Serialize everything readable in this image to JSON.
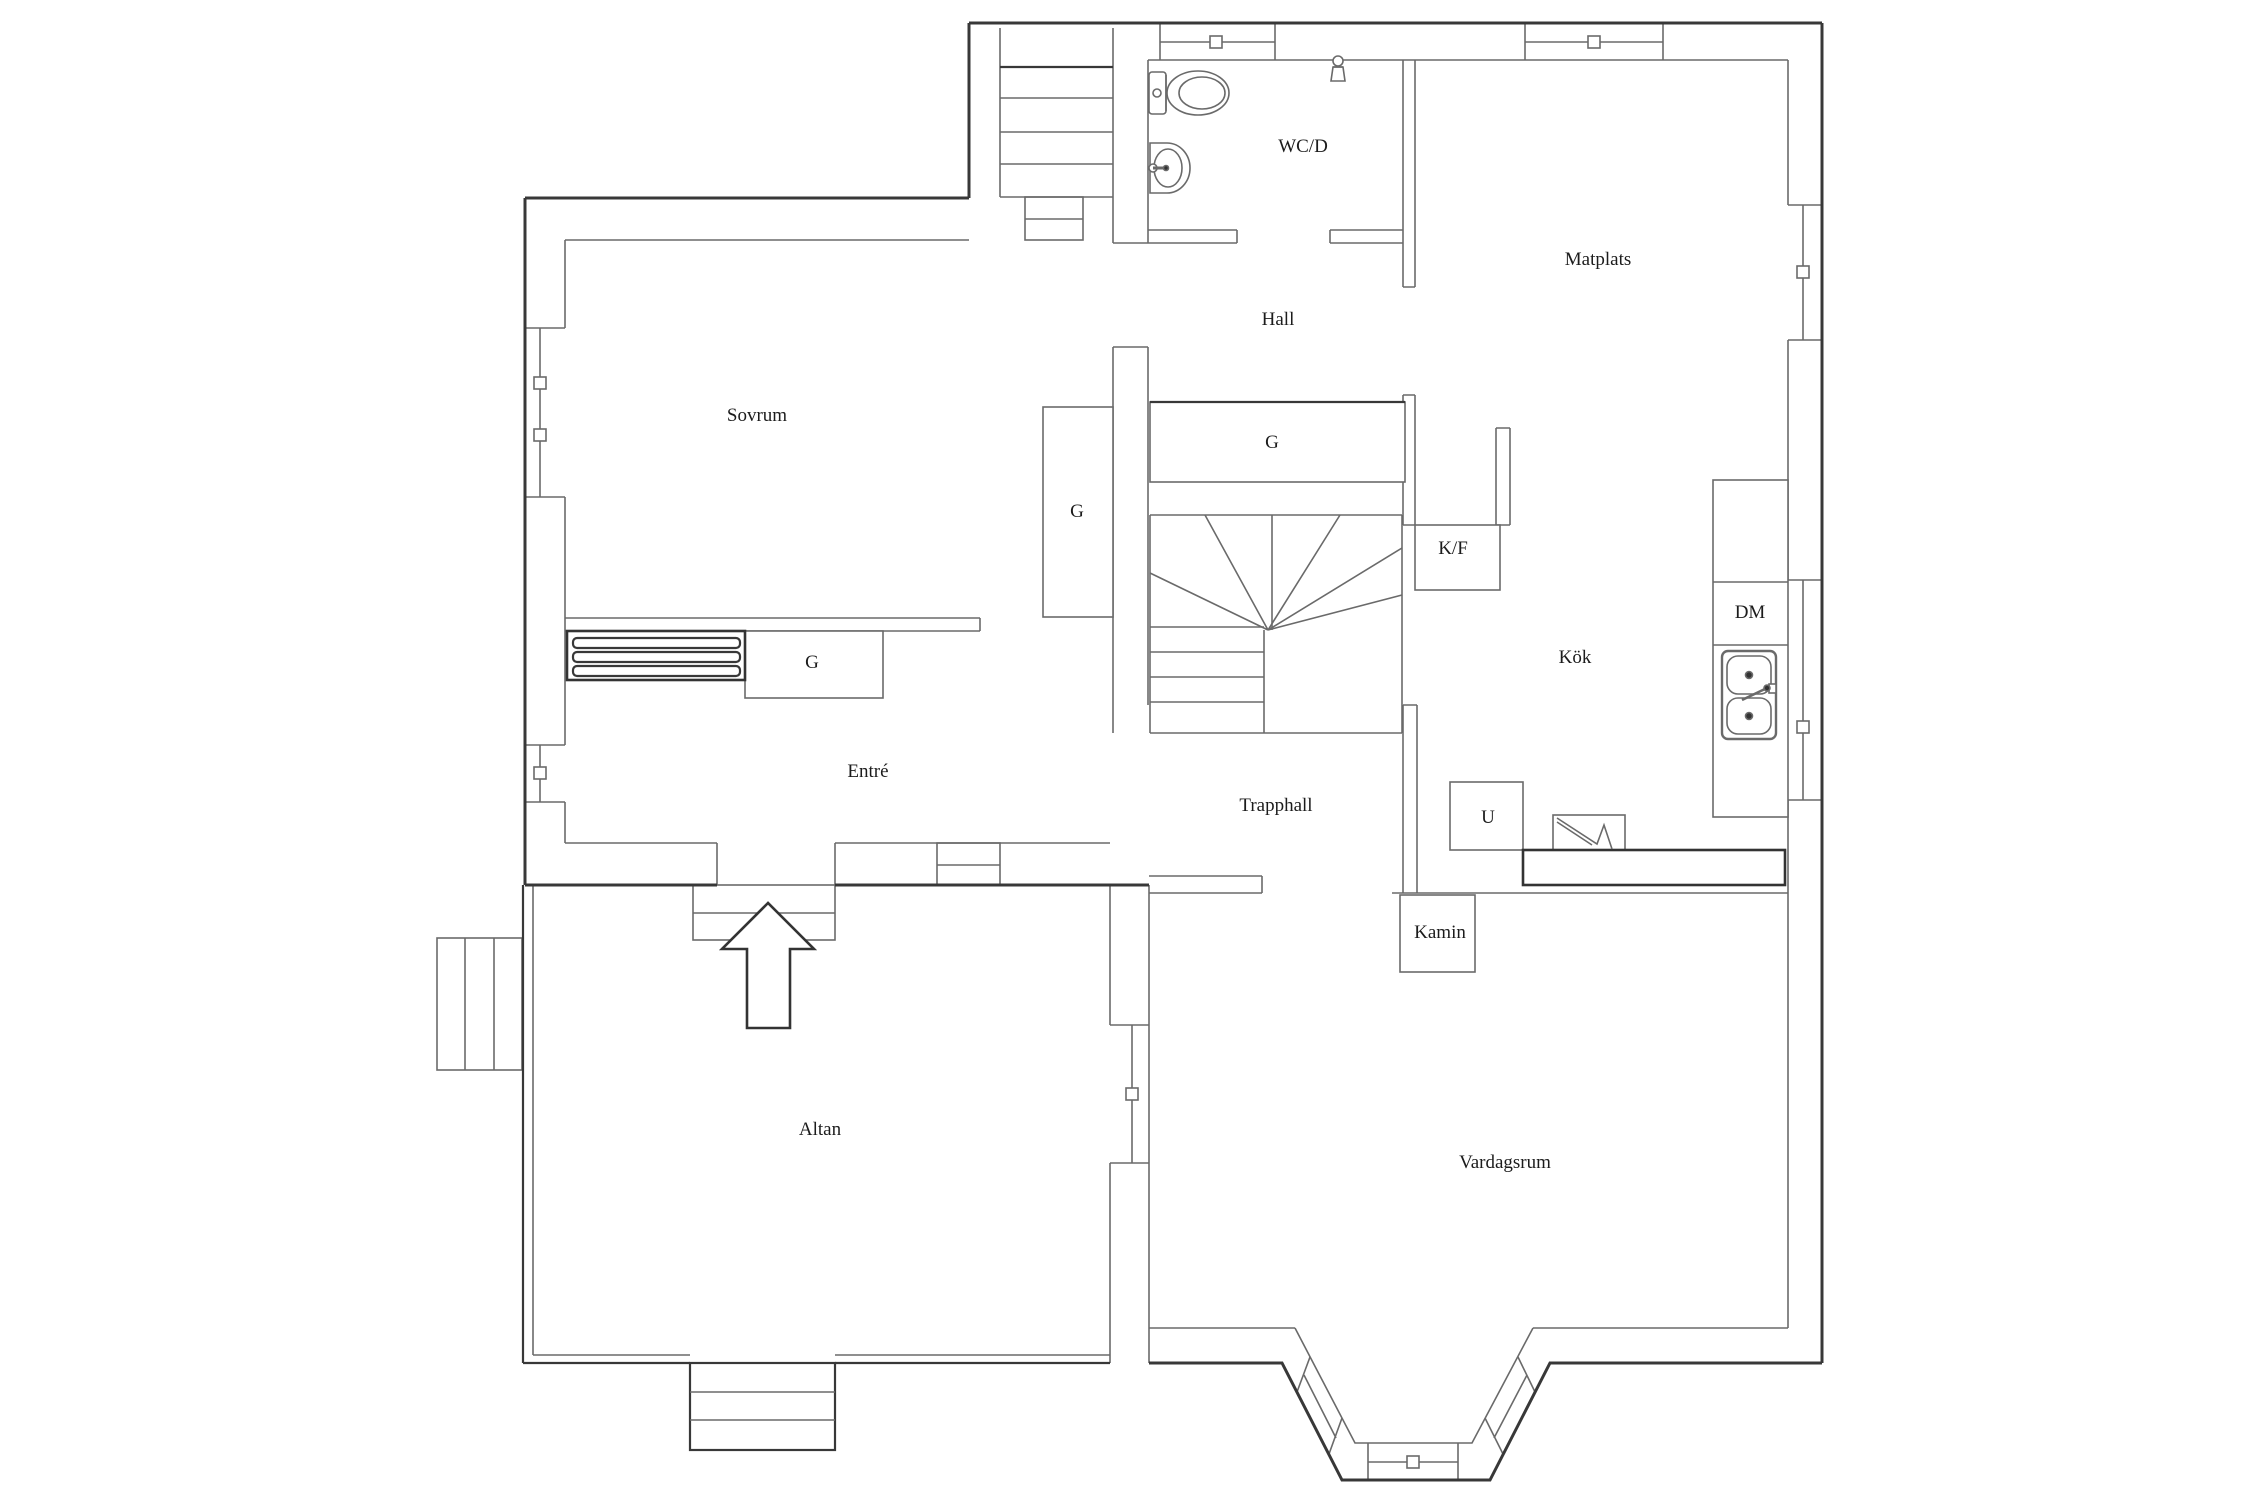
{
  "plan": {
    "title": "Floor plan, entrance level",
    "rooms": {
      "sovrum": {
        "label": "Sovrum"
      },
      "wcd": {
        "label": "WC/D"
      },
      "hall": {
        "label": "Hall"
      },
      "matplats": {
        "label": "Matplats"
      },
      "entre": {
        "label": "Entré"
      },
      "trapphall": {
        "label": "Trapphall"
      },
      "kok": {
        "label": "Kök"
      },
      "altan": {
        "label": "Altan"
      },
      "vardagsrum": {
        "label": "Vardagsrum"
      }
    },
    "fixtures": {
      "g_hall": {
        "label": "G"
      },
      "g_sovrum": {
        "label": "G"
      },
      "g_entre": {
        "label": "G"
      },
      "kf": {
        "label": "K/F"
      },
      "dm": {
        "label": "DM"
      },
      "ugn": {
        "label": "U"
      },
      "kamin": {
        "label": "Kamin"
      }
    },
    "colors": {
      "wall_dark": "#383838",
      "wall_thin": "#6a6a6a",
      "background": "#ffffff",
      "text": "#1c1c1c"
    }
  }
}
